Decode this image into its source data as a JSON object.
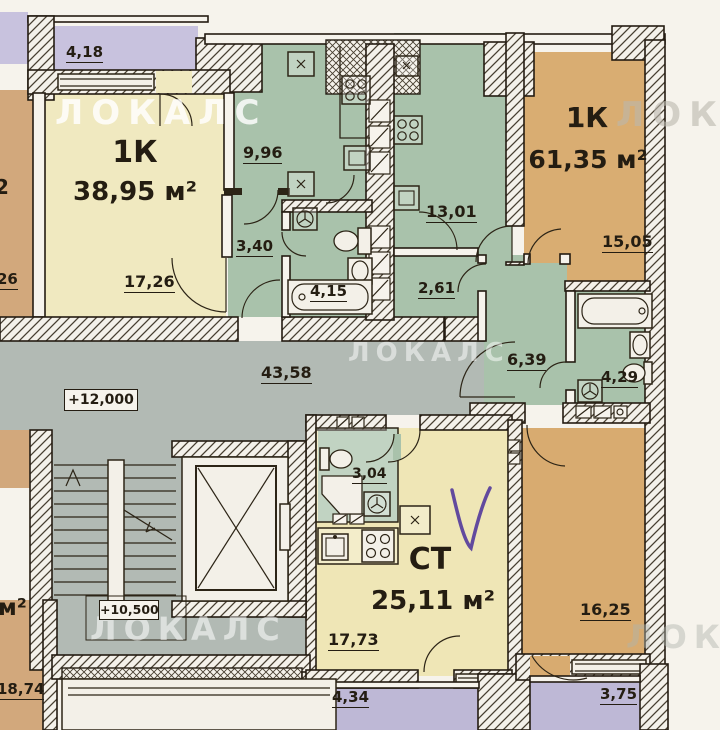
{
  "plan": {
    "watermark": "ЛОКАЛС",
    "labels": {
      "balcony_418": "4,18",
      "apt1_type": "1К",
      "apt1_area": "38,95 м²",
      "apt1_room": "17,26",
      "apt1_kitchen": "9,96",
      "apt1_hall": "3,40",
      "apt1_bath": "4,15",
      "apt2_type": "1К",
      "apt2_area": "61,35 м²",
      "apt2_room": "15,05",
      "apt2_kitchen": "13,01",
      "apt2_hall": "2,61",
      "apt2_entry_hall": "6,39",
      "apt2_bath": "4,29",
      "corridor": "43,58",
      "elevation_corridor": "+12,000",
      "elevation_stairs": "+10,500",
      "studio_type": "СТ",
      "studio_area": "25,11 м²",
      "studio_room": "17,73",
      "studio_bath": "3,04",
      "room_1625": "16,25",
      "balcony_434": "4,34",
      "balcony_375": "3,75",
      "left_top_unit_fragment": "2",
      "left_top_room_fragment": "26",
      "left_bottom_unit": "м²",
      "left_bottom_room": "18,74",
      "handwritten_mark": "V"
    },
    "colors": {
      "paper": "#f6f3ec",
      "room_yellow": "#f0e9c0",
      "studio_yellow": "#efe6b6",
      "room_tan": "#d9ad72",
      "wet_green": "#a9c2ab",
      "balcony_lavender": "#c8c2de",
      "corridor_gray": "#b2bab4",
      "ink": "#241d12",
      "handwriting": "#52389b"
    }
  }
}
